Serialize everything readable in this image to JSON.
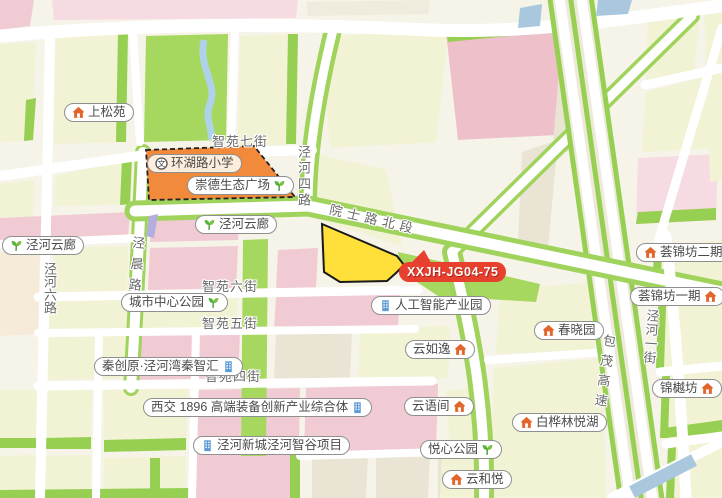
{
  "parcel": {
    "code": "XXJH-JG04-75",
    "fill": "#ffdf3a",
    "border": "#1a1a1a",
    "badge_color": "#e8402e"
  },
  "school_parcel": {
    "fill": "#f28a3c",
    "border": "#222222"
  },
  "colors": {
    "road_green_edge": "#96cf52",
    "block_pale_yellow": "#f2f2d4",
    "block_pink": "#f1cbd3",
    "block_rose": "#eec1ca",
    "block_light_pink": "#f7dbe2",
    "block_cream": "#efecdd",
    "block_greige": "#e9e4d3",
    "park_green": "#a6d75f",
    "water_blue": "#a9c8de",
    "poi_house_icon": "#e2652b",
    "poi_park_icon": "#57b33e",
    "poi_building_icon": "#5b9bd5"
  },
  "places": [
    {
      "label": "上松苑",
      "icon": "house-icon",
      "icon_side": "left"
    },
    {
      "label": "环湖路小学",
      "icon": "school-icon",
      "icon_side": "left"
    },
    {
      "label": "崇德生态广场",
      "icon": "park-icon",
      "icon_side": "right"
    },
    {
      "label": "泾河云廊",
      "icon": "park-icon",
      "icon_side": "left"
    },
    {
      "label": "泾河云廊",
      "icon": "park-icon",
      "icon_side": "left"
    },
    {
      "label": "城市中心公园",
      "icon": "park-icon",
      "icon_side": "right"
    },
    {
      "label": "人工智能产业园",
      "icon": "building-icon",
      "icon_side": "left"
    },
    {
      "label": "荟锦坊二期",
      "icon": "house-icon",
      "icon_side": "left"
    },
    {
      "label": "荟锦坊一期",
      "icon": "house-icon",
      "icon_side": "right"
    },
    {
      "label": "春晓园",
      "icon": "house-icon",
      "icon_side": "left"
    },
    {
      "label": "云如逸",
      "icon": "house-icon",
      "icon_side": "right"
    },
    {
      "label": "秦创原·泾河湾秦智汇",
      "icon": "building-icon",
      "icon_side": "right"
    },
    {
      "label": "西交 1896 高端装备创新产业综合体",
      "icon": "building-icon",
      "icon_side": "right"
    },
    {
      "label": "泾河新城泾河智谷项目",
      "icon": "building-icon",
      "icon_side": "left"
    },
    {
      "label": "云语间",
      "icon": "house-icon",
      "icon_side": "right"
    },
    {
      "label": "悦心公园",
      "icon": "park-icon",
      "icon_side": "right"
    },
    {
      "label": "白桦林悦湖",
      "icon": "house-icon",
      "icon_side": "left"
    },
    {
      "label": "云和悦",
      "icon": "house-icon",
      "icon_side": "left"
    },
    {
      "label": "锦樾坊",
      "icon": "house-icon",
      "icon_side": "right"
    }
  ],
  "roads": [
    {
      "label": "智苑七街"
    },
    {
      "label": "泾河四路"
    },
    {
      "label": "院士路北段"
    },
    {
      "label": "泾河六路"
    },
    {
      "label": "泾晨路"
    },
    {
      "label": "智苑六街"
    },
    {
      "label": "智苑五街"
    },
    {
      "label": "智苑四街"
    },
    {
      "label": "包茂高速"
    },
    {
      "label": "泾河一街"
    }
  ]
}
